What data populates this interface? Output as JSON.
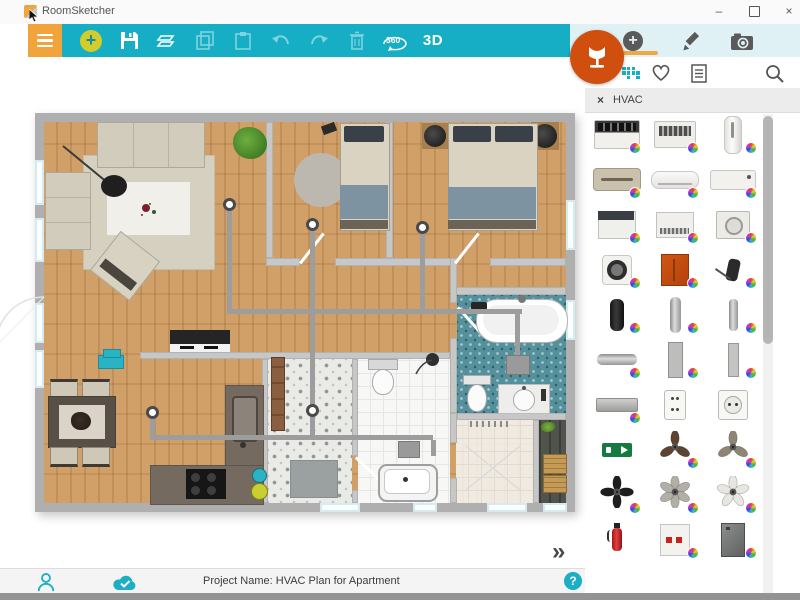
{
  "window": {
    "title": "RoomSketcher",
    "minimize": "–",
    "close": "×"
  },
  "toolbar": {
    "label_360": "360",
    "label_3d": "3D"
  },
  "panel": {
    "filter_close": "×",
    "filter_label": "HVAC",
    "products": [
      {
        "name": "ptac-air-conditioner",
        "shape": "ac-ptac",
        "badge": true
      },
      {
        "name": "window-air-conditioner",
        "shape": "ac-window",
        "badge": true
      },
      {
        "name": "portable-ac-tower",
        "shape": "tower-white",
        "badge": true
      },
      {
        "name": "wall-ac-beige",
        "shape": "wall-ac-beige",
        "badge": true
      },
      {
        "name": "mini-split-ac",
        "shape": "mini-split",
        "badge": true
      },
      {
        "name": "wall-ac-white",
        "shape": "wall-ac-white",
        "badge": true
      },
      {
        "name": "rooftop-ac-unit",
        "shape": "box-dark-top",
        "badge": true
      },
      {
        "name": "ac-unit-vented",
        "shape": "box-vent",
        "badge": true
      },
      {
        "name": "ceiling-cassette-vent",
        "shape": "ceiling-cassette",
        "badge": true
      },
      {
        "name": "round-wall-vent",
        "shape": "round-vent",
        "badge": true
      },
      {
        "name": "wall-cabinet-orange",
        "shape": "cabinet-orange",
        "badge": true
      },
      {
        "name": "vacuum-cleaner",
        "shape": "vacuum",
        "badge": true
      },
      {
        "name": "tower-fan-black",
        "shape": "tower-black",
        "badge": true
      },
      {
        "name": "pipe-vertical",
        "shape": "pipe-v",
        "badge": true
      },
      {
        "name": "pipe-vertical-2",
        "shape": "pipe-v2",
        "badge": true
      },
      {
        "name": "pipe-horizontal",
        "shape": "pipe-h",
        "badge": true
      },
      {
        "name": "duct-vertical",
        "shape": "duct-v",
        "badge": true
      },
      {
        "name": "duct-vertical-slim",
        "shape": "duct-v2",
        "badge": true
      },
      {
        "name": "duct-horizontal",
        "shape": "duct-h",
        "badge": true
      },
      {
        "name": "wall-outlet-double",
        "shape": "outlet-double",
        "badge": false
      },
      {
        "name": "wall-outlet-round",
        "shape": "outlet-eu",
        "badge": false
      },
      {
        "name": "exit-sign",
        "shape": "exit-sign",
        "badge": false
      },
      {
        "name": "ceiling-fan-dark-wood",
        "shape": "fan-wood",
        "badge": true
      },
      {
        "name": "ceiling-fan-two-blade",
        "shape": "fan-two",
        "badge": true
      },
      {
        "name": "ceiling-fan-black",
        "shape": "fan-black",
        "badge": true
      },
      {
        "name": "ceiling-fan-gray",
        "shape": "fan-gray",
        "badge": true
      },
      {
        "name": "ceiling-fan-white",
        "shape": "fan-white",
        "badge": true
      },
      {
        "name": "fire-extinguisher",
        "shape": "extinguisher",
        "badge": false
      },
      {
        "name": "fire-hose-cabinet",
        "shape": "fire-cabinet",
        "badge": true
      },
      {
        "name": "metal-cabinet-gray",
        "shape": "cabinet-gray",
        "badge": true
      },
      {
        "name": "vent-grille-1",
        "shape": "vent-low",
        "badge": false
      },
      {
        "name": "vent-grille-2",
        "shape": "vent-low",
        "badge": false
      },
      {
        "name": "vent-grille-3",
        "shape": "vent-low",
        "badge": false
      }
    ]
  },
  "canvas": {
    "expand_label": "»"
  },
  "statusbar": {
    "project_label": "Project Name: HVAC Plan for Apartment",
    "help_label": "?"
  },
  "colors": {
    "toolbar_teal": "#15AEC5",
    "menu_orange": "#F2A43C",
    "furniture_button_orange": "#D14F0E",
    "tab_underline_orange": "#F0A843",
    "help_teal": "#1BAEC5"
  }
}
